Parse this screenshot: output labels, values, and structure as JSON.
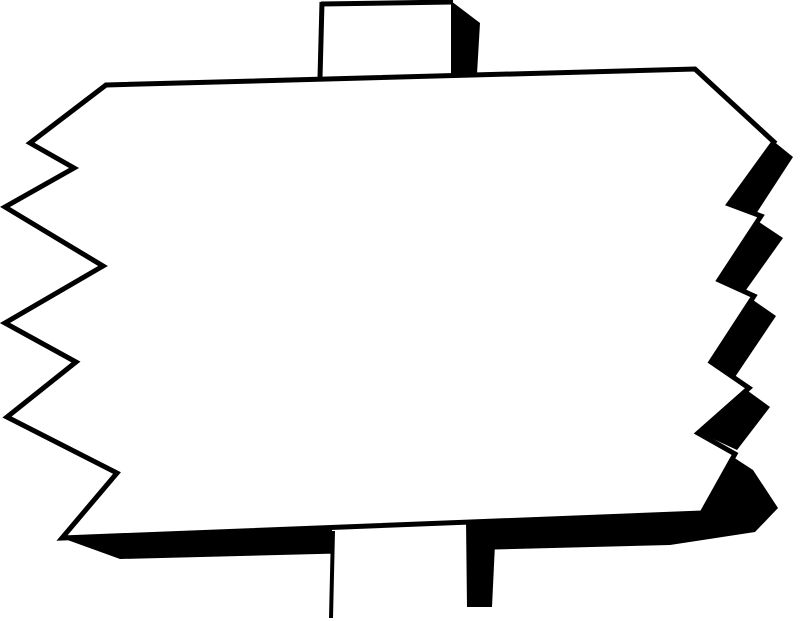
{
  "artwork": {
    "description": "Black-and-white clipart drawing of a blank wooden signboard with jagged zigzag left and right edges, mounted on a vertical post visible above and below the board, with a heavy black drop shadow along the right and bottom edges.",
    "colors": {
      "ink": "#000000",
      "paper": "#ffffff"
    },
    "shapes": [
      {
        "name": "right-shadow-wedge-1",
        "type": "polygon",
        "fill": "ink",
        "points": [
          [
            772,
            140
          ],
          [
            793,
            157
          ],
          [
            752,
            220
          ],
          [
            727,
            202
          ]
        ]
      },
      {
        "name": "right-shadow-wedge-2",
        "type": "polygon",
        "fill": "ink",
        "points": [
          [
            759,
            222
          ],
          [
            783,
            238
          ],
          [
            741,
            297
          ],
          [
            717,
            278
          ]
        ]
      },
      {
        "name": "right-shadow-wedge-3",
        "type": "polygon",
        "fill": "ink",
        "points": [
          [
            753,
            300
          ],
          [
            776,
            316
          ],
          [
            733,
            380
          ],
          [
            709,
            360
          ]
        ]
      },
      {
        "name": "right-shadow-wedge-4",
        "type": "polygon",
        "fill": "ink",
        "points": [
          [
            748,
            391
          ],
          [
            770,
            407
          ],
          [
            737,
            450
          ],
          [
            696,
            431
          ]
        ]
      },
      {
        "name": "bottom-shadow-band",
        "type": "polygon",
        "fill": "ink",
        "points": [
          [
            733,
            457
          ],
          [
            702,
            512
          ],
          [
            62,
            538
          ],
          [
            120,
            559
          ],
          [
            670,
            545
          ],
          [
            755,
            532
          ],
          [
            778,
            508
          ],
          [
            753,
            470
          ]
        ]
      },
      {
        "name": "bottom-post-face",
        "type": "polygon",
        "fill": "paper",
        "points": [
          [
            332,
            526
          ],
          [
            468,
            520
          ],
          [
            468,
            621
          ],
          [
            332,
            621
          ]
        ]
      },
      {
        "name": "bottom-post-left-edge",
        "type": "polyline",
        "stroke": "ink",
        "width": 4,
        "points": [
          [
            333,
            531
          ],
          [
            331,
            618
          ]
        ]
      },
      {
        "name": "bottom-post-shadow",
        "type": "polygon",
        "fill": "ink",
        "points": [
          [
            466,
            520
          ],
          [
            496,
            523
          ],
          [
            492,
            607
          ],
          [
            467,
            607
          ]
        ]
      },
      {
        "name": "top-post-face",
        "type": "polygon",
        "fill": "paper",
        "points": [
          [
            322,
            3
          ],
          [
            453,
            1
          ],
          [
            453,
            75
          ],
          [
            320,
            79
          ]
        ]
      },
      {
        "name": "top-post-left-edge",
        "type": "polyline",
        "stroke": "ink",
        "width": 5,
        "points": [
          [
            322,
            2
          ],
          [
            320,
            78
          ]
        ]
      },
      {
        "name": "top-post-top-edge",
        "type": "polyline",
        "stroke": "ink",
        "width": 5,
        "points": [
          [
            321,
            4
          ],
          [
            453,
            2
          ]
        ]
      },
      {
        "name": "top-post-shadow",
        "type": "polygon",
        "fill": "ink",
        "points": [
          [
            451,
            1
          ],
          [
            480,
            23
          ],
          [
            477,
            74
          ],
          [
            451,
            74
          ]
        ]
      },
      {
        "name": "sign-board",
        "type": "polygon",
        "fill": "paper",
        "stroke": "ink",
        "width": 5,
        "points": [
          [
            106,
            85
          ],
          [
            695,
            69
          ],
          [
            774,
            142
          ],
          [
            729,
            204
          ],
          [
            761,
            216
          ],
          [
            719,
            280
          ],
          [
            754,
            296
          ],
          [
            711,
            362
          ],
          [
            749,
            388
          ],
          [
            698,
            433
          ],
          [
            735,
            454
          ],
          [
            702,
            513
          ],
          [
            62,
            538
          ],
          [
            117,
            473
          ],
          [
            7,
            417
          ],
          [
            76,
            362
          ],
          [
            5,
            323
          ],
          [
            103,
            266
          ],
          [
            5,
            207
          ],
          [
            74,
            168
          ],
          [
            30,
            143
          ]
        ]
      }
    ]
  }
}
